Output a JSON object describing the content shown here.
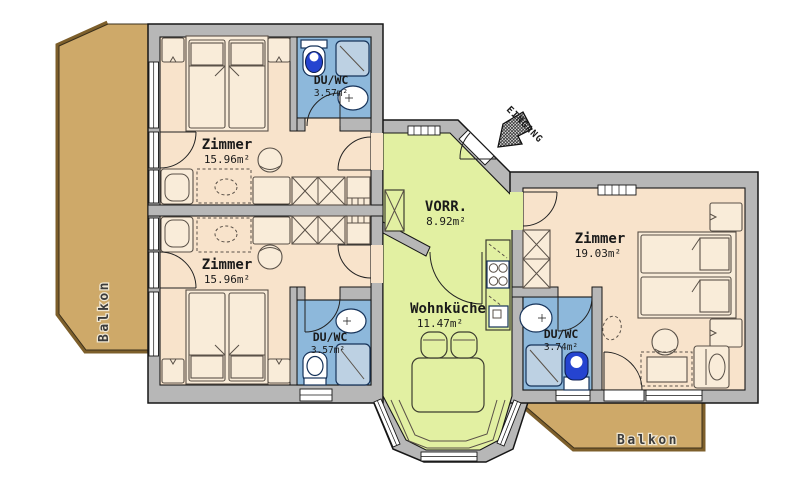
{
  "floorplan": {
    "entrance": {
      "label": "EINGANG"
    },
    "rooms": {
      "zimmer_top_left": {
        "name": "Zimmer",
        "area": "15.96m²"
      },
      "zimmer_bottom_left": {
        "name": "Zimmer",
        "area": "15.96m²"
      },
      "zimmer_right": {
        "name": "Zimmer",
        "area": "19.03m²"
      },
      "du_wc_top": {
        "name": "DU/WC",
        "area": "3.57m²"
      },
      "du_wc_bottom": {
        "name": "DU/WC",
        "area": "3.57m²"
      },
      "du_wc_right": {
        "name": "DU/WC",
        "area": "3.74m²"
      },
      "vorraum": {
        "name": "VORR.",
        "area": "8.92m²"
      },
      "wohnkueche": {
        "name": "Wohnküche",
        "area": "11.47m²"
      }
    },
    "balconies": {
      "left": {
        "label": "Balkon"
      },
      "right": {
        "label": "Balkon"
      }
    },
    "colors": {
      "room_floor": "#f8e3cb",
      "hall_floor": "#e2f0a2",
      "bath_floor": "#8db8db",
      "balcony_floor": "#cea969",
      "balcony_edge": "#7d5f2b",
      "wall": "#b7b7b7",
      "outline": "#161616",
      "window": "#ffffff",
      "wc_seat_blue": "#2544d0",
      "shower_tray": "#bdd1e3",
      "furniture_fill": "#f9ecd9"
    }
  }
}
